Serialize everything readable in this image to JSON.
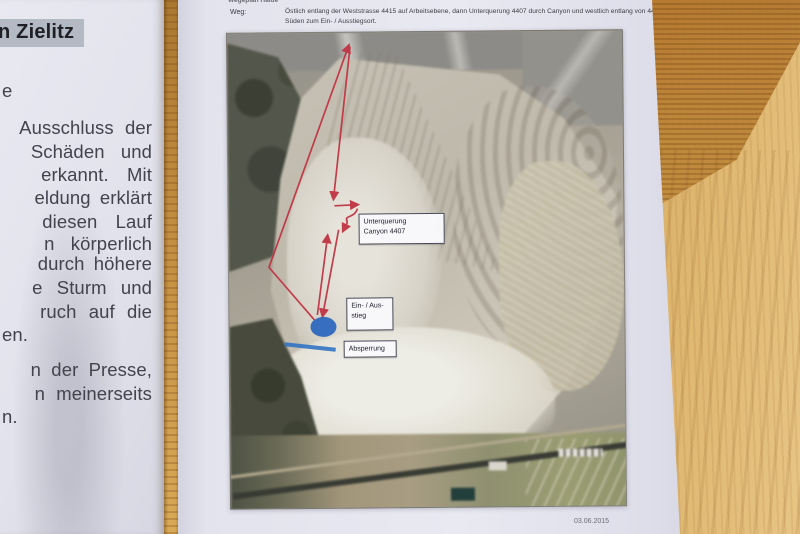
{
  "left_page": {
    "highlight_title": "n Zielitz",
    "lines": [
      "e",
      "Ausschluss der",
      "Schäden und",
      "erkannt.  Mit",
      "eldung erklärt",
      "diesen  Lauf",
      "n  körperlich",
      "durch höhere",
      "e Sturm und",
      "ruch auf die",
      "en.",
      "n der Presse,",
      "n meinerseits",
      "n."
    ]
  },
  "main_page": {
    "header_fragment": "Wegeplan Halde",
    "weg_label": "Weg:",
    "weg_line1": "Östlich entlang der Weststrasse 4415 auf Arbeitsebene, dann Unterquerung 4407 durch Canyon und westlich entlang von 4407 Richtung",
    "weg_line2": "Süden zum Ein- / Ausstiegsort.",
    "footer_date": "03.06.2015",
    "photo_labels": {
      "unterquerung_line1": "Unterquerung",
      "unterquerung_line2": "Canyon 4407",
      "einausstieg_line1": "Ein- / Aus-",
      "einausstieg_line2": "stieg",
      "absperrung": "Absperrung"
    }
  },
  "colors": {
    "annotation_red": "#c03040",
    "annotation_blue": "#2a66bd",
    "barrier_blue": "#2e72c4",
    "highlight_gray": "#b4bac3",
    "wood_brown": "#cd9a48"
  }
}
